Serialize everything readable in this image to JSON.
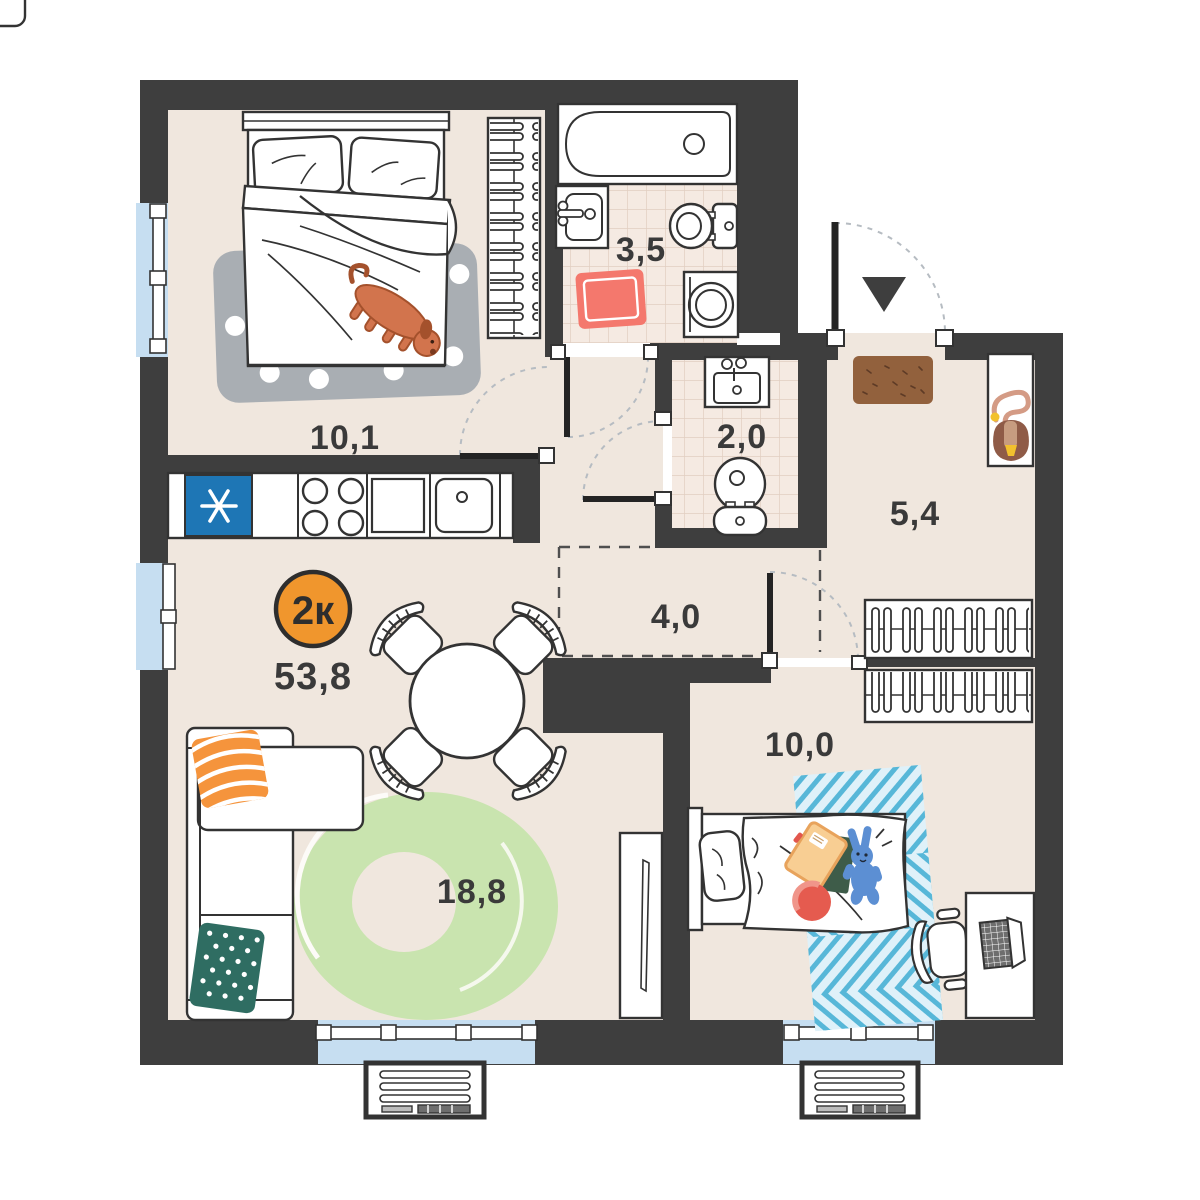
{
  "plan": {
    "badge": {
      "label": "2к",
      "total_area": "53,8",
      "color": "#F0962D"
    },
    "rooms": {
      "bedroom": {
        "area": "10,1"
      },
      "bathroom": {
        "area": "3,5"
      },
      "toilet": {
        "area": "2,0"
      },
      "hallway": {
        "area": "5,4"
      },
      "corridor": {
        "area": "4,0"
      },
      "kids_room": {
        "area": "10,0"
      },
      "living_kitchen": {
        "area": "18,8"
      }
    },
    "colors": {
      "wall": "#3E3E3E",
      "floor": "#F0E7DE",
      "tile": "#F5EAE2",
      "window_glass": "#C6DEF1",
      "fridge_blue": "#1E76B5",
      "rug_green": "#C9E4AF",
      "rug_gray": "#A9AEB3",
      "rug_red": "#F4786D",
      "rug_kids_blue": "#57B7D8",
      "pillow_orange": "#F5943C",
      "pillow_teal": "#2F6D62",
      "doormat_brown": "#92613D",
      "dog_orange": "#D2744D",
      "toy_bunny_blue": "#5C8FD3"
    }
  }
}
